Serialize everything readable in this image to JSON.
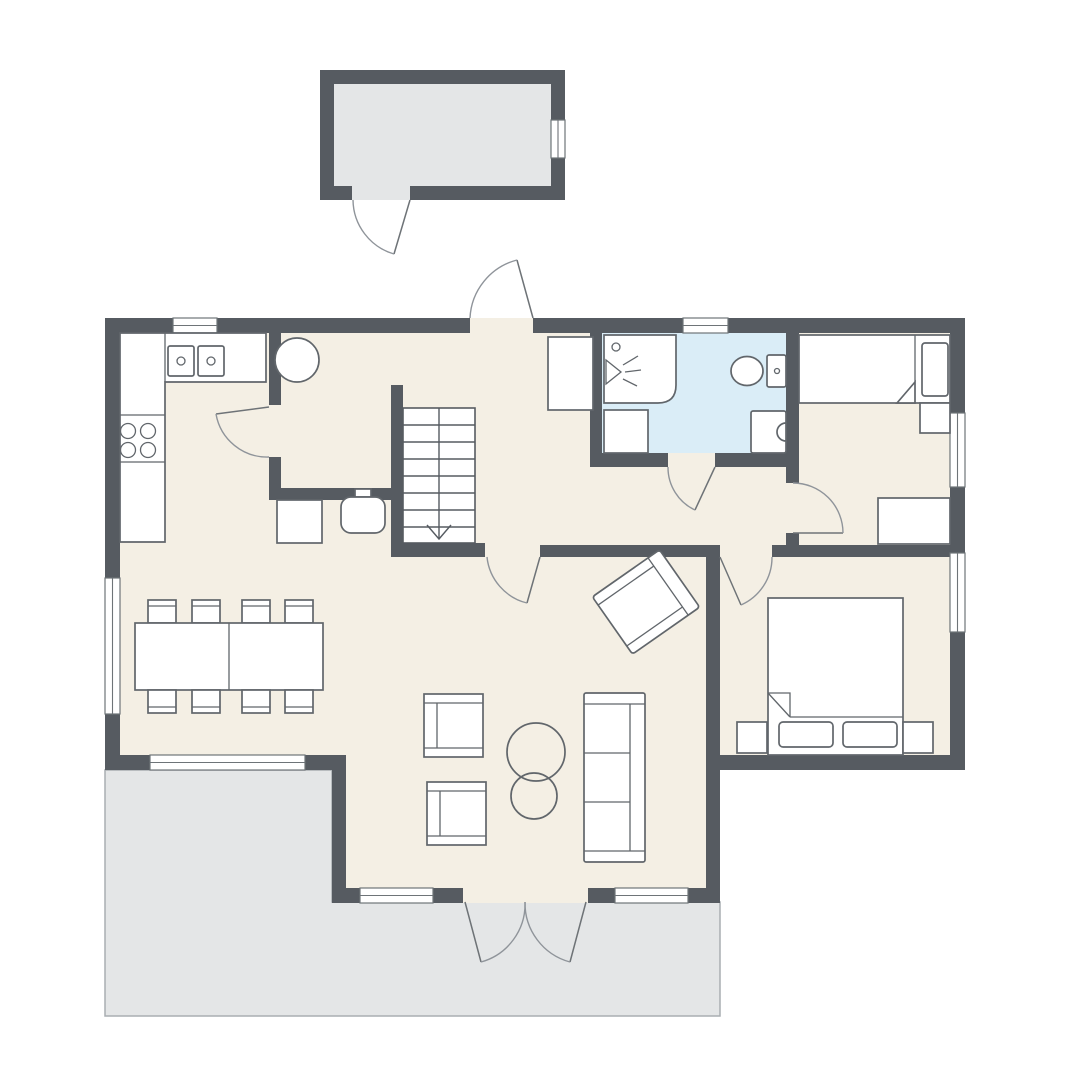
{
  "canvas": {
    "width": 1080,
    "height": 1080,
    "background": "#ffffff"
  },
  "colors": {
    "wall": "#565b61",
    "floor": "#f4efe4",
    "bathroom_floor": "#daedf7",
    "outdoor": "#e4e6e7",
    "furniture_fill": "#ffffff",
    "furniture_line": "#61666b",
    "window_line": "#6e7478",
    "door_arc": "#8f949a",
    "door_leaf": "#6e7377",
    "terrace_border": "#a9aeb2"
  },
  "buildings": {
    "shed": {
      "name": "detached-shed",
      "windows": 1,
      "exterior_doors": 1,
      "floor": "gray"
    },
    "house": {
      "name": "main-house",
      "windows": 8,
      "exterior_doors": 2,
      "interior_doors": 5,
      "floor": "cream"
    }
  },
  "rooms": [
    {
      "name": "kitchen",
      "furniture": [
        "l-shaped-counter",
        "double-sink",
        "cooktop-four-burners"
      ]
    },
    {
      "name": "entry-hall",
      "furniture": [
        "round-table",
        "wardrobe",
        "staircase-down",
        "wood-stove",
        "cabinet"
      ]
    },
    {
      "name": "bathroom",
      "floor": "blue",
      "furniture": [
        "shower",
        "washing-machine",
        "toilet",
        "washbasin"
      ]
    },
    {
      "name": "bedroom-upper",
      "furniture": [
        "single-bed",
        "pillow",
        "nightstand",
        "desk"
      ]
    },
    {
      "name": "bedroom-lower",
      "furniture": [
        "double-bed",
        "two-pillows",
        "nightstand-left",
        "nightstand-right"
      ]
    },
    {
      "name": "dining-area",
      "furniture": [
        "dining-table",
        "eight-chairs"
      ]
    },
    {
      "name": "living-room",
      "furniture": [
        "sofa-three-seats",
        "armchair",
        "armchair",
        "armchair-rotated",
        "round-coffee-table-large",
        "round-coffee-table-small"
      ]
    },
    {
      "name": "terrace",
      "furniture": []
    }
  ],
  "stairs": {
    "direction": "down",
    "treads": 8
  }
}
